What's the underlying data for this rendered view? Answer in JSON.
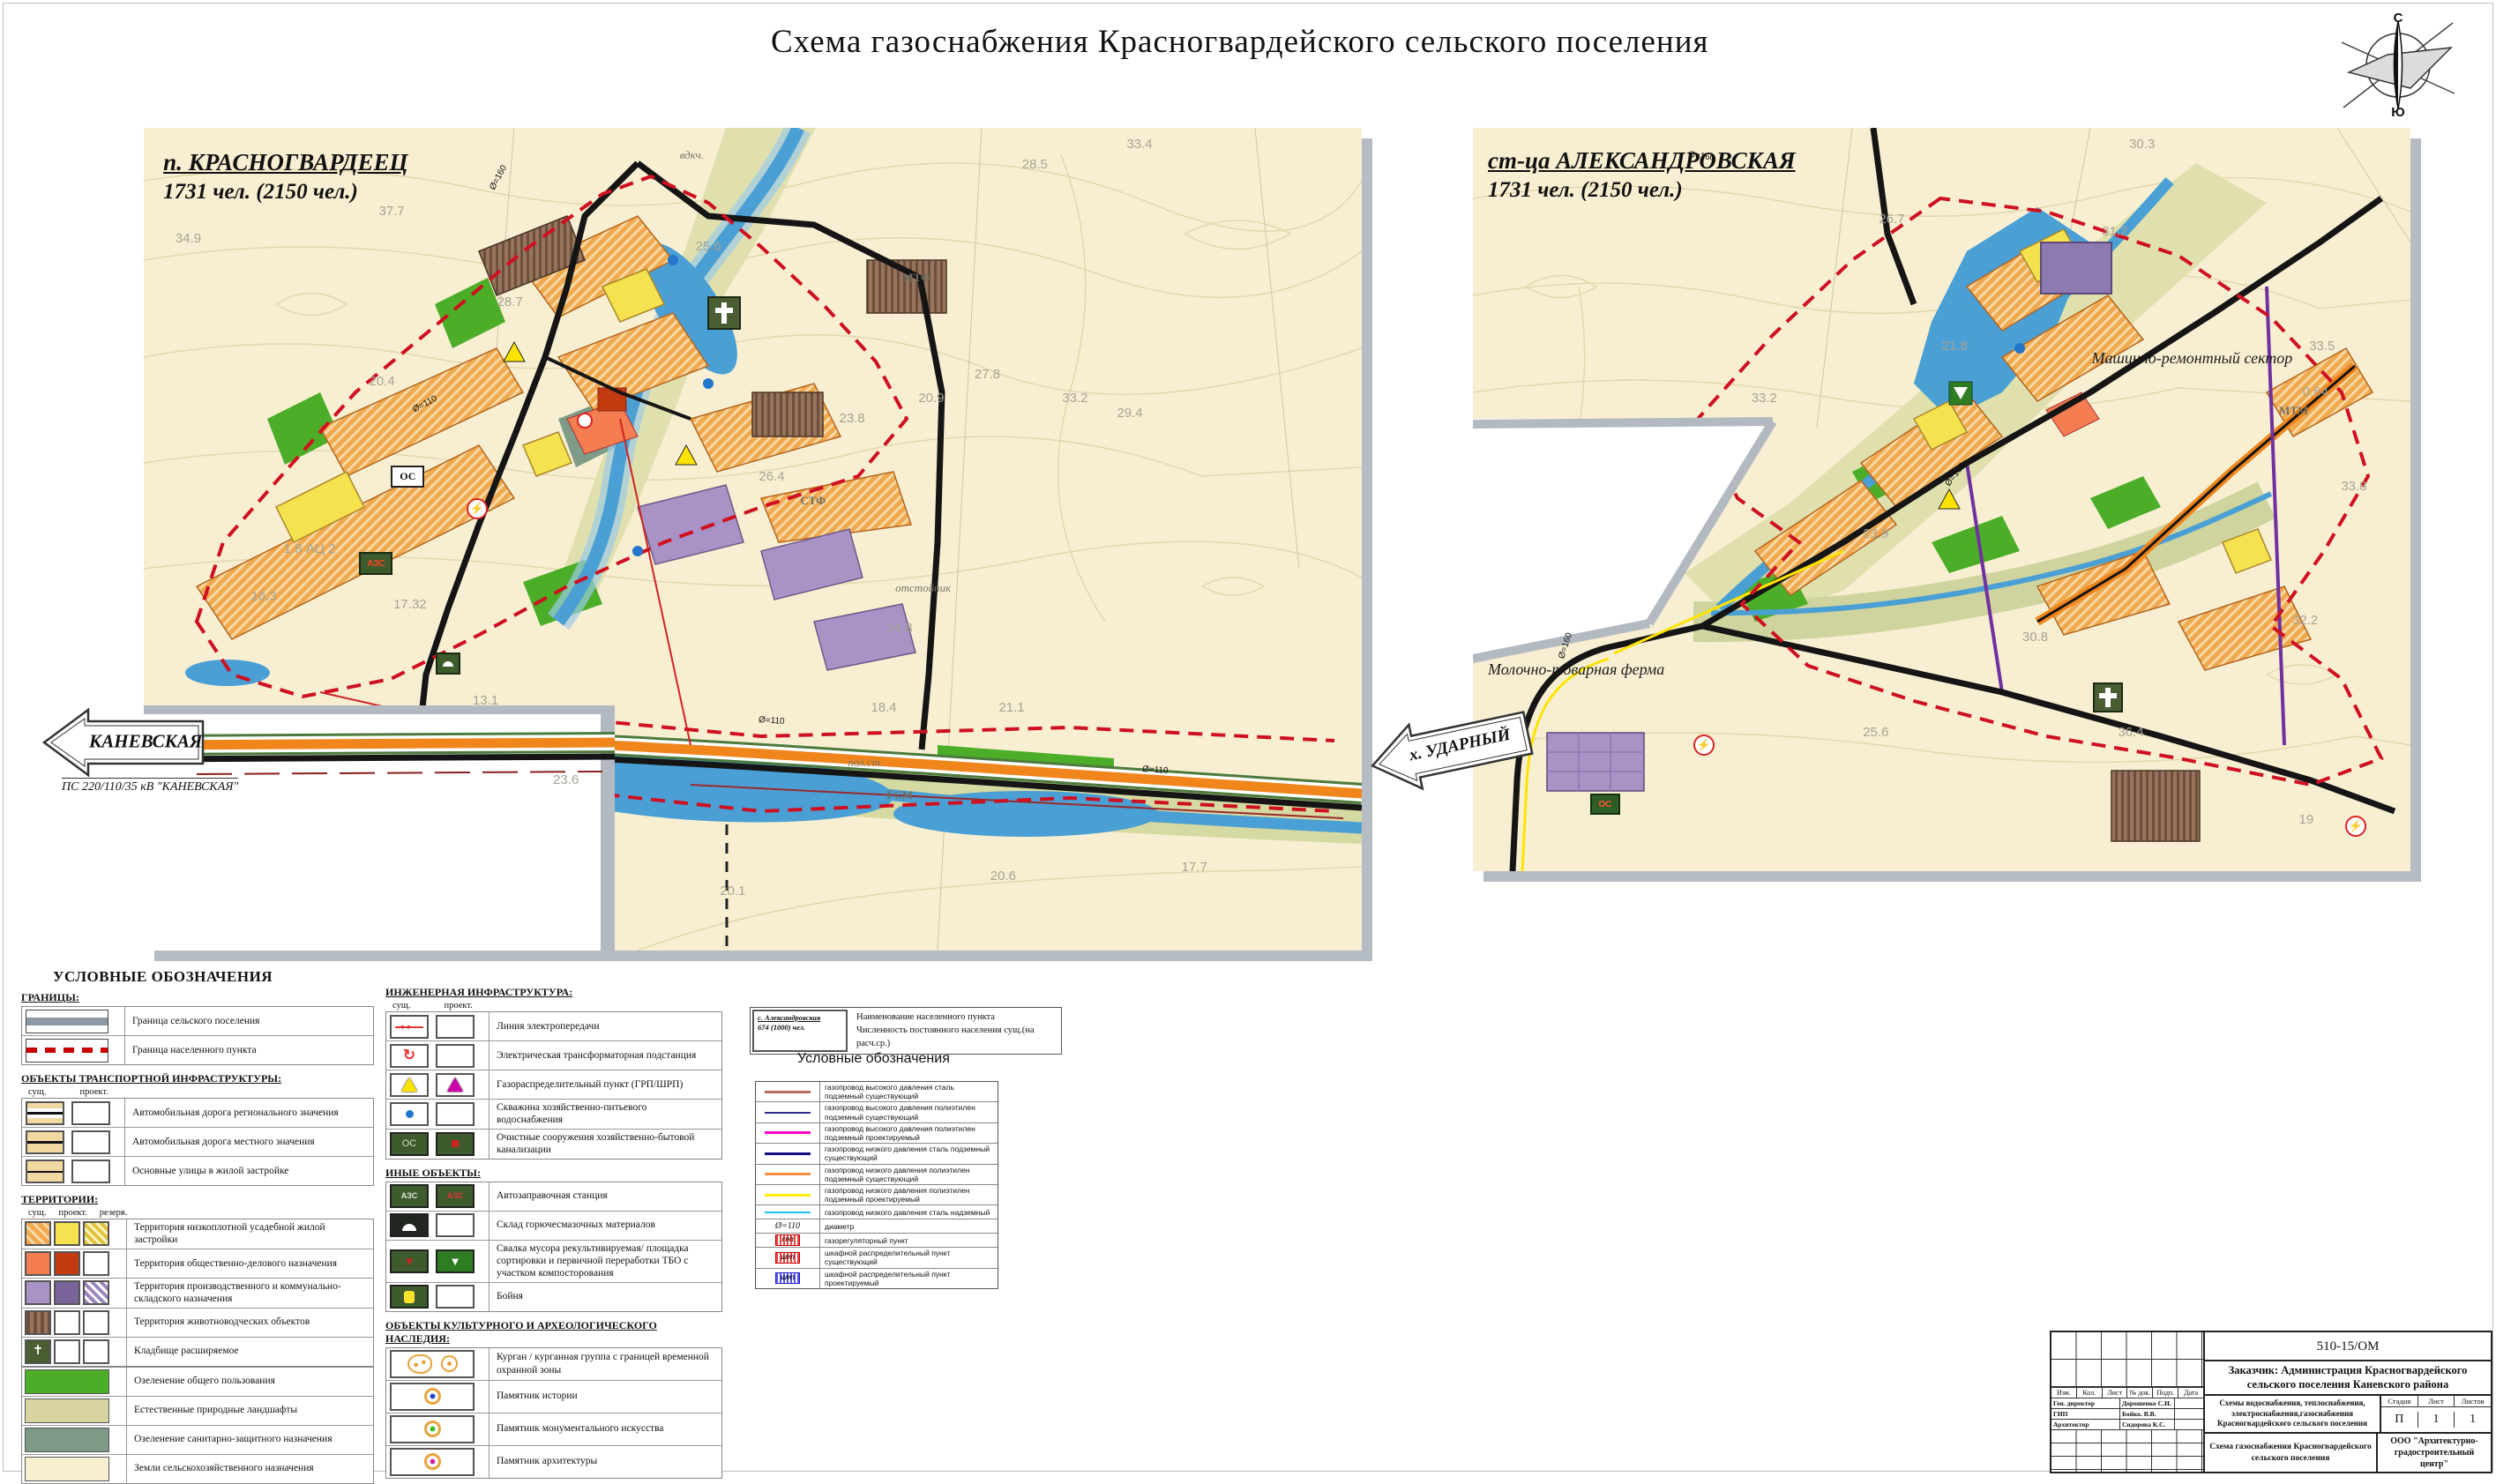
{
  "page": {
    "title": "Схема  газоснабжения Красногвардейского сельского поселения"
  },
  "compass": {
    "north": "С",
    "south": "Ю"
  },
  "colors": {
    "boundary_red": "#cf1020",
    "road_orange": "#f0851c",
    "river_blue": "#4a9fd4",
    "residential_orange": "#f0a94f",
    "industrial_purple": "#a992c6",
    "green_public": "#4cae28",
    "map_paper": "#f8efd2"
  },
  "left_map": {
    "name": "п. КРАСНОГВАРДЕЕЦ",
    "population": "1731 чел. (2150 чел.)",
    "sign": "КАНЕВСКАЯ",
    "sign_sub": "ПС 220/110/35 кВ \"КАНЕВСКАЯ\"",
    "elevations": [
      {
        "t": "34.9",
        "pos": "left:2.6%;top:12.5%"
      },
      {
        "t": "37.7",
        "pos": "left:19.3%;top:9.2%"
      },
      {
        "t": "25.6",
        "pos": "left:45.3%;top:13.5%"
      },
      {
        "t": "28.5",
        "pos": "left:72.1%;top:3.5%"
      },
      {
        "t": "33.4",
        "pos": "left:80.7%;top:1.1%"
      },
      {
        "t": "28.7",
        "pos": "left:29.0%;top:20.3%"
      },
      {
        "t": "20.4",
        "pos": "left:18.5%;top:29.9%"
      },
      {
        "t": "27.8",
        "pos": "left:68.2%;top:29.0%"
      },
      {
        "t": "20.9",
        "pos": "left:63.6%;top:31.9%"
      },
      {
        "t": "33.2",
        "pos": "left:75.4%;top:31.9%"
      },
      {
        "t": "29.4",
        "pos": "left:79.9%;top:33.8%"
      },
      {
        "t": "23.8",
        "pos": "left:57.1%;top:34.4%"
      },
      {
        "t": "26.4",
        "pos": "left:50.5%;top:41.5%"
      },
      {
        "t": "1.8 АЦ 2",
        "pos": "left:11.5%;top:50.3%"
      },
      {
        "t": "16.3",
        "pos": "left:8.8%;top:56.1%"
      },
      {
        "t": "17.32",
        "pos": "left:20.5%;top:57.0%"
      },
      {
        "t": "24.8",
        "pos": "left:61.0%;top:59.9%"
      },
      {
        "t": "18.4",
        "pos": "left:59.7%;top:69.6%"
      },
      {
        "t": "21.1",
        "pos": "left:70.2%;top:69.6%"
      },
      {
        "t": "13.1",
        "pos": "left:27.0%;top:68.7%"
      },
      {
        "t": "23.6",
        "pos": "left:33.6%;top:78.3%"
      },
      {
        "t": "20.1",
        "pos": "left:47.3%;top:91.9%"
      },
      {
        "t": "20.6",
        "pos": "left:69.5%;top:90.0%"
      },
      {
        "t": "17.7",
        "pos": "left:85.2%;top:89.0%"
      }
    ],
    "labels": [
      {
        "t": "МТФ",
        "cls": "maplabel small-gray",
        "pos": "left:62.3%;top:17.4%"
      },
      {
        "t": "СТФ",
        "cls": "maplabel small-gray",
        "pos": "left:53.9%;top:44.5%"
      },
      {
        "t": "отстойник",
        "cls": "maplabel it-gray",
        "pos": "left:61.7%;top:55.1%"
      },
      {
        "t": "пол.ст.",
        "cls": "maplabel it-gray",
        "pos": "left:57.8%;top:76.3%"
      },
      {
        "t": "ГСМ",
        "cls": "maplabel small-gray",
        "pos": "left:61.0%;top:80.3%"
      },
      {
        "t": "вдкч.",
        "cls": "maplabel it-gray",
        "pos": "left:44.0%;top:2.5%"
      }
    ],
    "pipes": [
      {
        "t": "Ø=160",
        "pos": "left:28%;top:5.5%;transform:rotate(-62deg)"
      },
      {
        "t": "Ø=110",
        "pos": "left:22%;top:33%;transform:rotate(-28deg)"
      },
      {
        "t": "Ø=110",
        "pos": "left:50.5%;top:71.5%;transform:rotate(4deg)"
      },
      {
        "t": "Ø=110",
        "pos": "left:82%;top:77.5%;transform:rotate(4deg)"
      }
    ],
    "badges": [
      {
        "t": "ОС",
        "cls": "badge oc-white",
        "pos": "left:20.3%;top:41.0%"
      },
      {
        "t": "АЗС",
        "cls": "badge badge-azs",
        "pos": "left:17.7%;top:51.6%"
      },
      {
        "t": "",
        "cls": "badge badge-dome",
        "pos": "left:24.0%;top:63.8%"
      },
      {
        "t": "⚡",
        "cls": "badge lightning",
        "pos": "left:26.5%;top:45.0%"
      }
    ]
  },
  "right_map": {
    "name": "ст-ца АЛЕКСАНДРОВСКАЯ",
    "population": "1731 чел. (2150 чел.)",
    "sign": "х. УДАРНЫЙ",
    "elevations": [
      {
        "t": "30.3",
        "pos": "left:70.0%;top:1.2%"
      },
      {
        "t": "26.7",
        "pos": "left:43.3%;top:11.3%"
      },
      {
        "t": "31.2",
        "pos": "left:67.1%;top:12.9%"
      },
      {
        "t": "33.5",
        "pos": "left:89.2%;top:28.4%"
      },
      {
        "t": "21.8",
        "pos": "left:50.0%;top:28.4%"
      },
      {
        "t": "33.2",
        "pos": "left:29.7%;top:35.3%"
      },
      {
        "t": "0.64",
        "pos": "left:88.5%;top:34.5%"
      },
      {
        "t": "33.8",
        "pos": "left:92.6%;top:47.2%"
      },
      {
        "t": "23.9",
        "pos": "left:41.6%;top:53.6%"
      },
      {
        "t": "30.8",
        "pos": "left:58.6%;top:67.5%"
      },
      {
        "t": "32.2",
        "pos": "left:87.4%;top:65.3%"
      },
      {
        "t": "25.6",
        "pos": "left:41.6%;top:80.3%"
      },
      {
        "t": "36.4",
        "pos": "left:68.8%;top:80.3%"
      },
      {
        "t": "19",
        "pos": "left:88.1%;top:92.0%"
      }
    ],
    "labels": [
      {
        "t": "Машинно-ремонтный сектор",
        "cls": "maplabel",
        "pos": "left:66%;top:29.8%"
      },
      {
        "t": "Молочно-товарная ферма",
        "cls": "maplabel",
        "pos": "left:1.6%;top:71.6%"
      },
      {
        "t": "МТМ",
        "cls": "maplabel small-gray",
        "pos": "left:86%;top:37.1%"
      }
    ],
    "pipes": [
      {
        "t": "Ø=160",
        "pos": "left:23%;top:3.2%;transform:rotate(8deg)"
      },
      {
        "t": "Ø=160",
        "pos": "left:50%;top:46%;transform:rotate(-52deg)"
      },
      {
        "t": "Ø=160",
        "pos": "left:8.5%;top:69%;transform:rotate(-72deg)"
      }
    ],
    "badges": [
      {
        "t": "ОС",
        "cls": "badge oc-green",
        "pos": "left:12.5%;top:89.6%"
      },
      {
        "t": "⚡",
        "cls": "badge lightning",
        "pos": "left:23.5%;top:81.6%"
      },
      {
        "t": "⚡",
        "cls": "badge lightning",
        "pos": "left:93.0%;top:92.5%"
      }
    ]
  },
  "legend": {
    "title": "УСЛОВНЫЕ ОБОЗНАЧЕНИЯ",
    "col_headers": {
      "such": "сущ.",
      "proekt": "проект.",
      "rezerv": "резерв."
    },
    "borders": {
      "title": "ГРАНИЦЫ:",
      "items": [
        {
          "label": "Граница сельского поселения",
          "c1": "sw w92 b-settlement"
        },
        {
          "label": "Граница населенного пункта",
          "c1": "sw w92 b-np"
        }
      ]
    },
    "transport": {
      "title": "ОБЪЕКТЫ ТРАНСПОРТНОЙ ИНФРАСТРУКТУРЫ:",
      "items": [
        {
          "label": "Автомобильная дорога регионального значения",
          "c1": "sw road-regional",
          "c2": "sw"
        },
        {
          "label": "Автомобильная дорога местного значения",
          "c1": "sw road-local",
          "c2": "sw"
        },
        {
          "label": "Основные улицы в жилой застройке",
          "c1": "sw road-street",
          "c2": "sw"
        }
      ]
    },
    "territories": {
      "title": "ТЕРРИТОРИИ:",
      "items3": [
        {
          "label": "Территория низкоплотной усадебной жилой застройки",
          "c1": "sw3 t-res-ex",
          "c2": "sw3 t-res-pr",
          "c3": "sw3 t-res-rz"
        },
        {
          "label": "Территория общественно-делового назначения",
          "c1": "sw3 t-pub-ex",
          "c2": "sw3 t-pub-pr",
          "c3": "sw3"
        },
        {
          "label": "Территория производственного и коммунально-складского назначения",
          "c1": "sw3 t-ind-ex",
          "c2": "sw3 t-ind-pr",
          "c3": "sw3 t-ind-rz"
        },
        {
          "label": "Территория животноводческих объектов",
          "c1": "sw3 t-farm-ex",
          "c2": "sw3",
          "c3": "sw3"
        },
        {
          "label": "Кладбище расширяемое",
          "c1": "sw3 t-cem",
          "g1": "✝",
          "c2": "sw3",
          "c3": "sw3"
        }
      ],
      "items_wide": [
        {
          "label": "Озеленение общего пользования",
          "c1": "sww g-public"
        },
        {
          "label": "Естественные природные ландшафты",
          "c1": "sww g-natural"
        },
        {
          "label": "Озеленение санитарно-защитного назначения",
          "c1": "sww g-sanitary"
        },
        {
          "label": "Земли сельскохозяйственного назначения",
          "c1": "sww g-agri"
        }
      ]
    },
    "engineering": {
      "title": "ИНЖЕНЕРНАЯ ИНФРАСТРУКТУРА:",
      "items": [
        {
          "label": "Линия электропередачи",
          "c1": "sw e-powerline",
          "c2": "sw"
        },
        {
          "label": "Электрическая трансформаторная подстанция",
          "c1": "sw e-tp",
          "c2": "sw"
        },
        {
          "label": "Газораспределительный пункт (ГРП/ШРП)",
          "c1": "sw e-grp-ex",
          "c2": "sw e-grp-pr"
        },
        {
          "label": "Скважина хозяйственно-питьевого водоснабжения",
          "c1": "sw e-well",
          "c2": "sw"
        },
        {
          "label": "Очистные сооружения хозяйственно-бытовой канализации",
          "c1": "sw e-os-ex",
          "g1": "ОС",
          "c2": "sw e-os-pr"
        }
      ]
    },
    "other_objects": {
      "title": "ИНЫЕ ОБЪЕКТЫ:",
      "items": [
        {
          "label": "Автозаправочная станция",
          "c1": "sw o-azs-ex",
          "g1": "АЗС",
          "c2": "sw o-azs-pr",
          "g2": "АЗС"
        },
        {
          "label": "Склад горючесмазочных материалов",
          "c1": "sw o-gsm",
          "c2": "sw"
        },
        {
          "label": "Свалка мусора рекультивируемая/ площадка сортировки и первичной переработки ТБО с участком компосторования",
          "c1": "sw o-dump-ex",
          "g1": "▼",
          "c2": "sw o-dump-pr",
          "g2": "▼"
        },
        {
          "label": "Бойня",
          "c1": "sw o-slaughter",
          "c2": "sw"
        }
      ]
    },
    "heritage": {
      "title": "ОБЪЕКТЫ КУЛЬТУРНОГО И  АРХЕОЛОГИЧЕСКОГО НАСЛЕДИЯ:",
      "items": [
        {
          "label": "Курган / курганная группа с границей временной охранной зоны",
          "c1": "swh h-kurgan"
        },
        {
          "label": "Памятник истории",
          "c1": "swh h-history"
        },
        {
          "label": "Памятник монументального искусства",
          "c1": "swh h-art"
        },
        {
          "label": "Памятник архитектуры",
          "c1": "swh h-arch"
        }
      ]
    },
    "sample_box": {
      "line1": "с. Александровская",
      "line2": "674 (1000) чел.",
      "desc1": "Наименование населенного пункта",
      "desc2": "Численность постоянного населения сущ.(на расч.ср.)"
    },
    "pipes": {
      "title": "Условные обозначения",
      "items": [
        {
          "label": "газопровод высокого давления сталь подземный существующий",
          "css": "background:#b96a60;height:3px"
        },
        {
          "label": "газопровод высокого давления полиэтилен подземный существующий",
          "css": "background:#2a2a8f;height:2px"
        },
        {
          "label": "газопровод высокого давления полиэтилен подземный проектируемый",
          "css": "background:#ff00d0;height:3px"
        },
        {
          "label": "газопровод низкого давления сталь подземный существующий",
          "css": "background:#101080;height:3px"
        },
        {
          "label": "газопровод низкого давления полиэтилен подземный существующий",
          "css": "background:#f79040;height:3px"
        },
        {
          "label": "газопровод низкого давления полиэтилен подземный проектируемый",
          "css": "background:#ffee00;height:3px"
        },
        {
          "label": "газопровод низкого давления сталь надземный",
          "css": "background:#20c0f0;height:2px"
        },
        {
          "label": "диаметр",
          "cls": "pl-line pl-txt",
          "txt": "Ø=110"
        },
        {
          "label": "газорегуляторный пункт",
          "cls": "pl-box",
          "txt": "ГРП"
        },
        {
          "label": "шкафной распределительный пункт существующий",
          "cls": "pl-box",
          "txt": "ШРП"
        },
        {
          "label": "шкафной распределительный пункт проектируемый",
          "cls": "pl-box shrp-blue",
          "txt": "ШРП"
        }
      ]
    }
  },
  "titleblock": {
    "code": "510-15/ОМ",
    "customer": "Заказчик: Администрация Красногвардейского сельского поселения Каневского района",
    "cols": [
      "Изм.",
      "Кол.",
      "Лист",
      "№ док.",
      "Подп.",
      "Дата"
    ],
    "roles": [
      {
        "role": "Ген. директор",
        "name": "Дорошенко С.И."
      },
      {
        "role": "ГИП",
        "name": "Бойко. В.В."
      },
      {
        "role": "Архитектор",
        "name": "Сидорова К.С."
      }
    ],
    "project": "Схемы водоснабжения, теплоснабжения, электроснабжения,газоснабжения Красногвардейского сельского поселения",
    "stage_headers": [
      "Стадия",
      "Лист",
      "Листов"
    ],
    "stage_values": [
      "П",
      "1",
      "1"
    ],
    "sheet_name": "Схема газоснабжения Красногвардейского сельского поселения",
    "company": "ООО \"Архитектурно-градостроительный центр\""
  }
}
